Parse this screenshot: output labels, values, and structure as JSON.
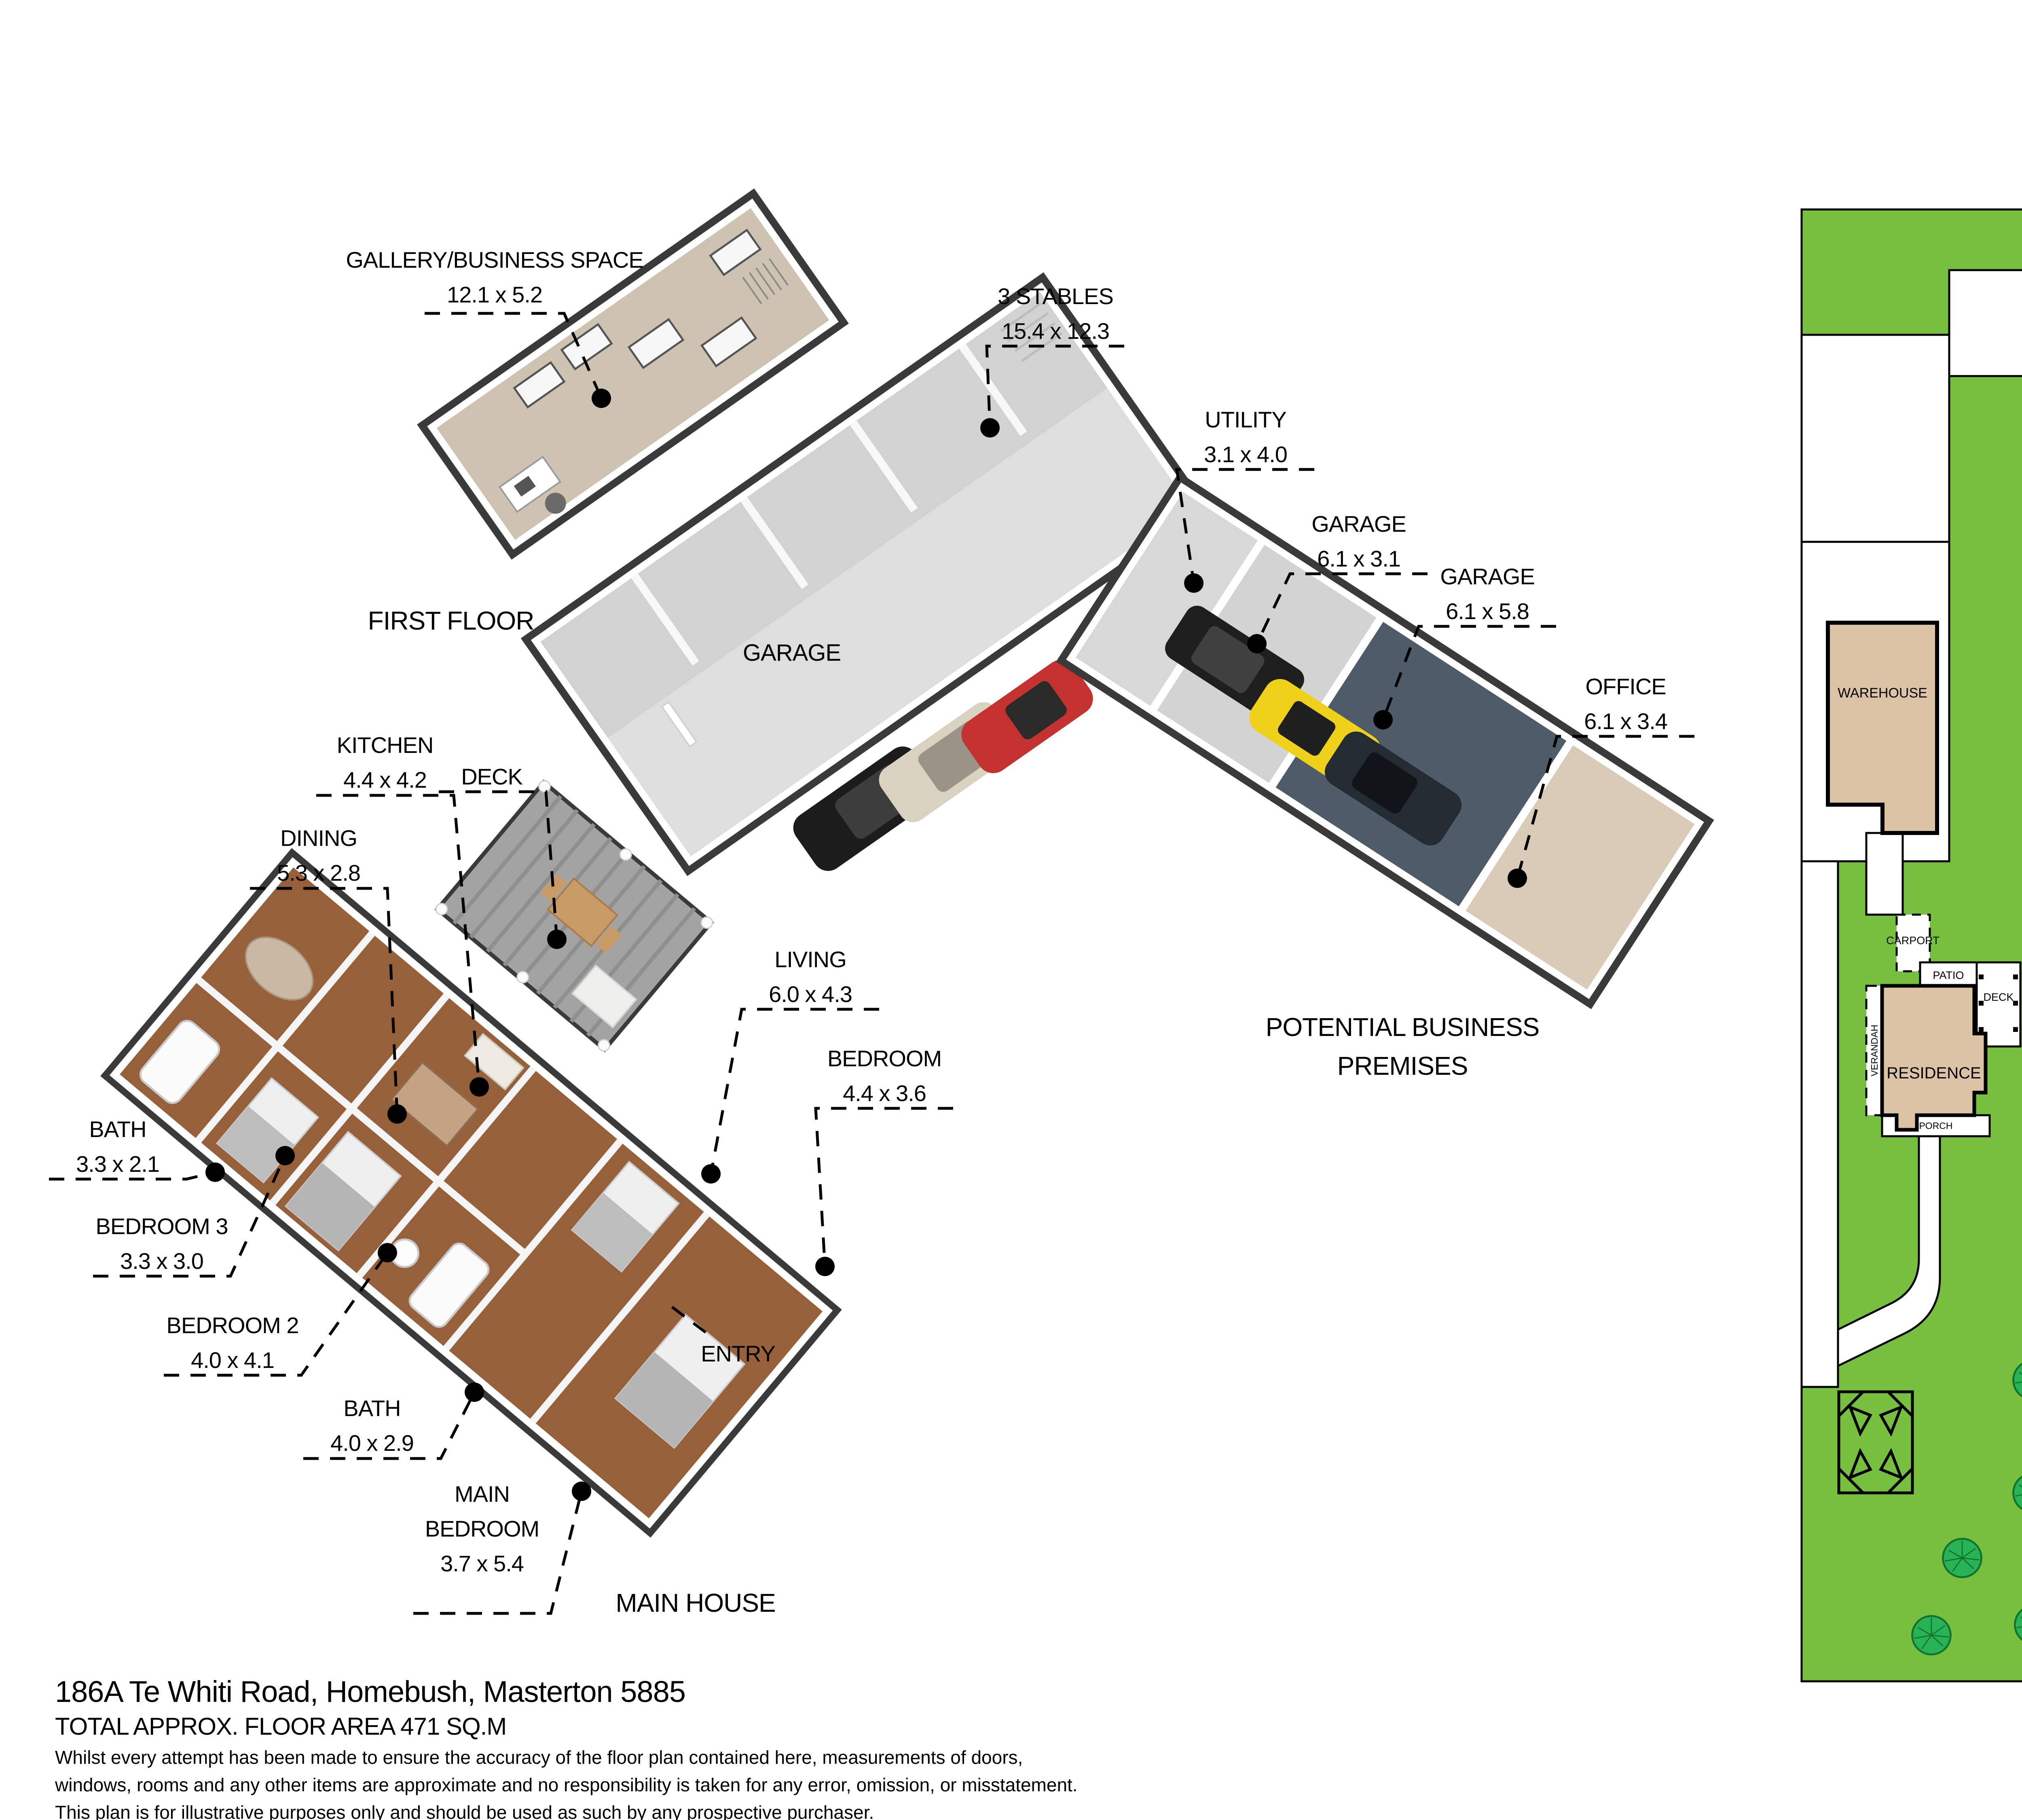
{
  "compass": {
    "north_label": "N"
  },
  "captions": {
    "first_floor": "FIRST FLOOR",
    "main_house": "MAIN HOUSE",
    "business_premises": "POTENTIAL BUSINESS PREMISES"
  },
  "rooms": {
    "gallery": {
      "name": "GALLERY/BUSINESS SPACE",
      "dims": "12.1 x 5.2"
    },
    "stables": {
      "name": "3 STABLES",
      "dims": "15.4 x 12.3"
    },
    "utility": {
      "name": "UTILITY",
      "dims": "3.1 x 4.0"
    },
    "garage1": {
      "name": "GARAGE",
      "dims": "6.1 x 3.1"
    },
    "garage2": {
      "name": "GARAGE",
      "dims": "6.1 x 5.8"
    },
    "office": {
      "name": "OFFICE",
      "dims": "6.1 x 3.4"
    },
    "garage_main": {
      "name": "GARAGE"
    },
    "kitchen": {
      "name": "KITCHEN",
      "dims": "4.4 x 4.2"
    },
    "deck": {
      "name": "DECK"
    },
    "dining": {
      "name": "DINING",
      "dims": "5.3 x 2.8"
    },
    "living": {
      "name": "LIVING",
      "dims": "6.0 x 4.3"
    },
    "bedroom": {
      "name": "BEDROOM",
      "dims": "4.4 x 3.6"
    },
    "bath1": {
      "name": "BATH",
      "dims": "3.3 x 2.1"
    },
    "bedroom3": {
      "name": "BEDROOM 3",
      "dims": "3.3 x 3.0"
    },
    "bedroom2": {
      "name": "BEDROOM 2",
      "dims": "4.0 x 4.1"
    },
    "bath2": {
      "name": "BATH",
      "dims": "4.0 x 2.9"
    },
    "main_bedroom": {
      "name": "MAIN BEDROOM",
      "dims": "3.7 x 5.4"
    },
    "entry": {
      "name": "ENTRY"
    }
  },
  "site_plan": {
    "shed": "SHED",
    "warehouse": "WAREHOUSE",
    "residence": "RESIDENCE",
    "carport": "CARPORT",
    "patio": "PATIO",
    "deck": "DECK",
    "verandah": "VERANDAH",
    "porch": "PORCH"
  },
  "footer": {
    "address": "186A Te Whiti Road, Homebush, Masterton 5885",
    "area": "TOTAL APPROX. FLOOR AREA 471 SQ.M",
    "disclaimer": [
      "Whilst every attempt has been made to ensure the accuracy of the floor plan contained here, measurements of doors,",
      "windows, rooms and any other items are approximate and no responsibility is taken for any error, omission, or misstatement.",
      "This plan is for illustrative purposes only and should be used as such by any prospective purchaser."
    ]
  },
  "colors": {
    "lawn_green": "#76bf3f",
    "tree_green": "#28b357",
    "building_tan": "#dcc3a5",
    "wood_floor": "#96613a",
    "garage_slate": "#4e5b68",
    "concrete_gray": "#d6d6d6",
    "carpet_beige": "#cec2b1",
    "wall_dark": "#3a3a3a",
    "car_red": "#c4322f",
    "car_yellow": "#efd11c",
    "car_black": "#1c1c1c",
    "car_beige": "#d9d2c0"
  }
}
